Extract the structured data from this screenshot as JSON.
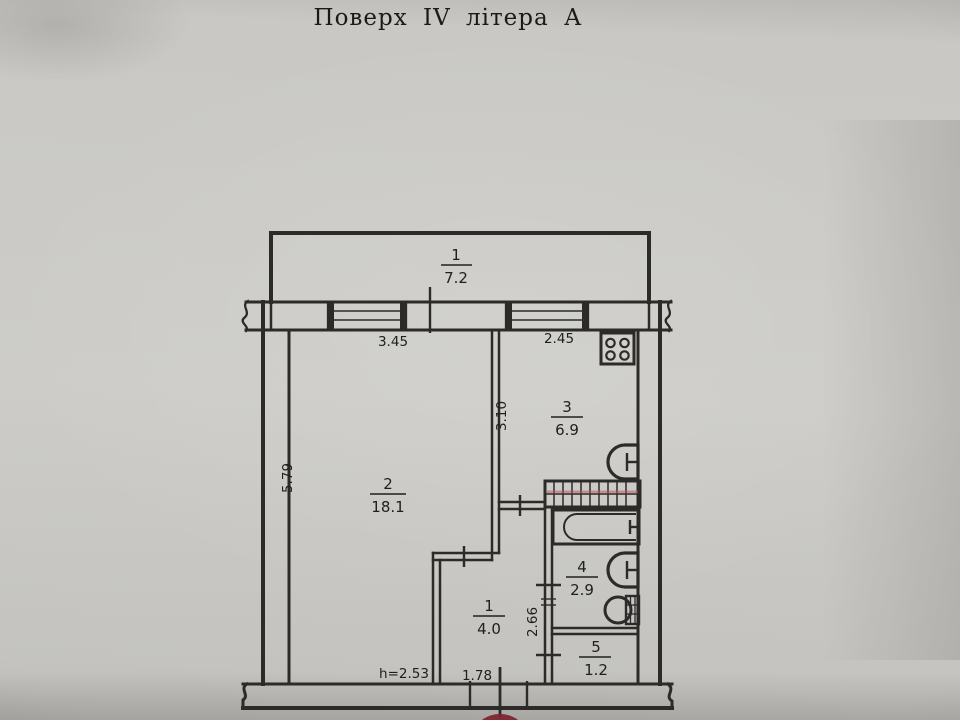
{
  "title": "Поверх IV літера А",
  "plan": {
    "rooms": [
      {
        "name": "balcony",
        "number": "1",
        "area": "7.2"
      },
      {
        "name": "living-room",
        "number": "2",
        "area": "18.1"
      },
      {
        "name": "kitchen",
        "number": "3",
        "area": "6.9"
      },
      {
        "name": "bathroom",
        "number": "4",
        "area": "2.9"
      },
      {
        "name": "hallway",
        "number": "1",
        "area": "4.0"
      },
      {
        "name": "wc",
        "number": "5",
        "area": "1.2"
      }
    ],
    "dimensions": {
      "living_width": "3.45",
      "kitchen_width": "2.45",
      "kitchen_depth": "3.10",
      "living_depth": "5.79",
      "hallway_side": "2.66",
      "hallway_width": "1.78",
      "ceiling_height": "h=2.53"
    },
    "colors": {
      "paper": "#c9c8c4",
      "ink": "#2c2b29",
      "stamp_red": "#7e2230",
      "vent_red": "#b05560"
    }
  }
}
